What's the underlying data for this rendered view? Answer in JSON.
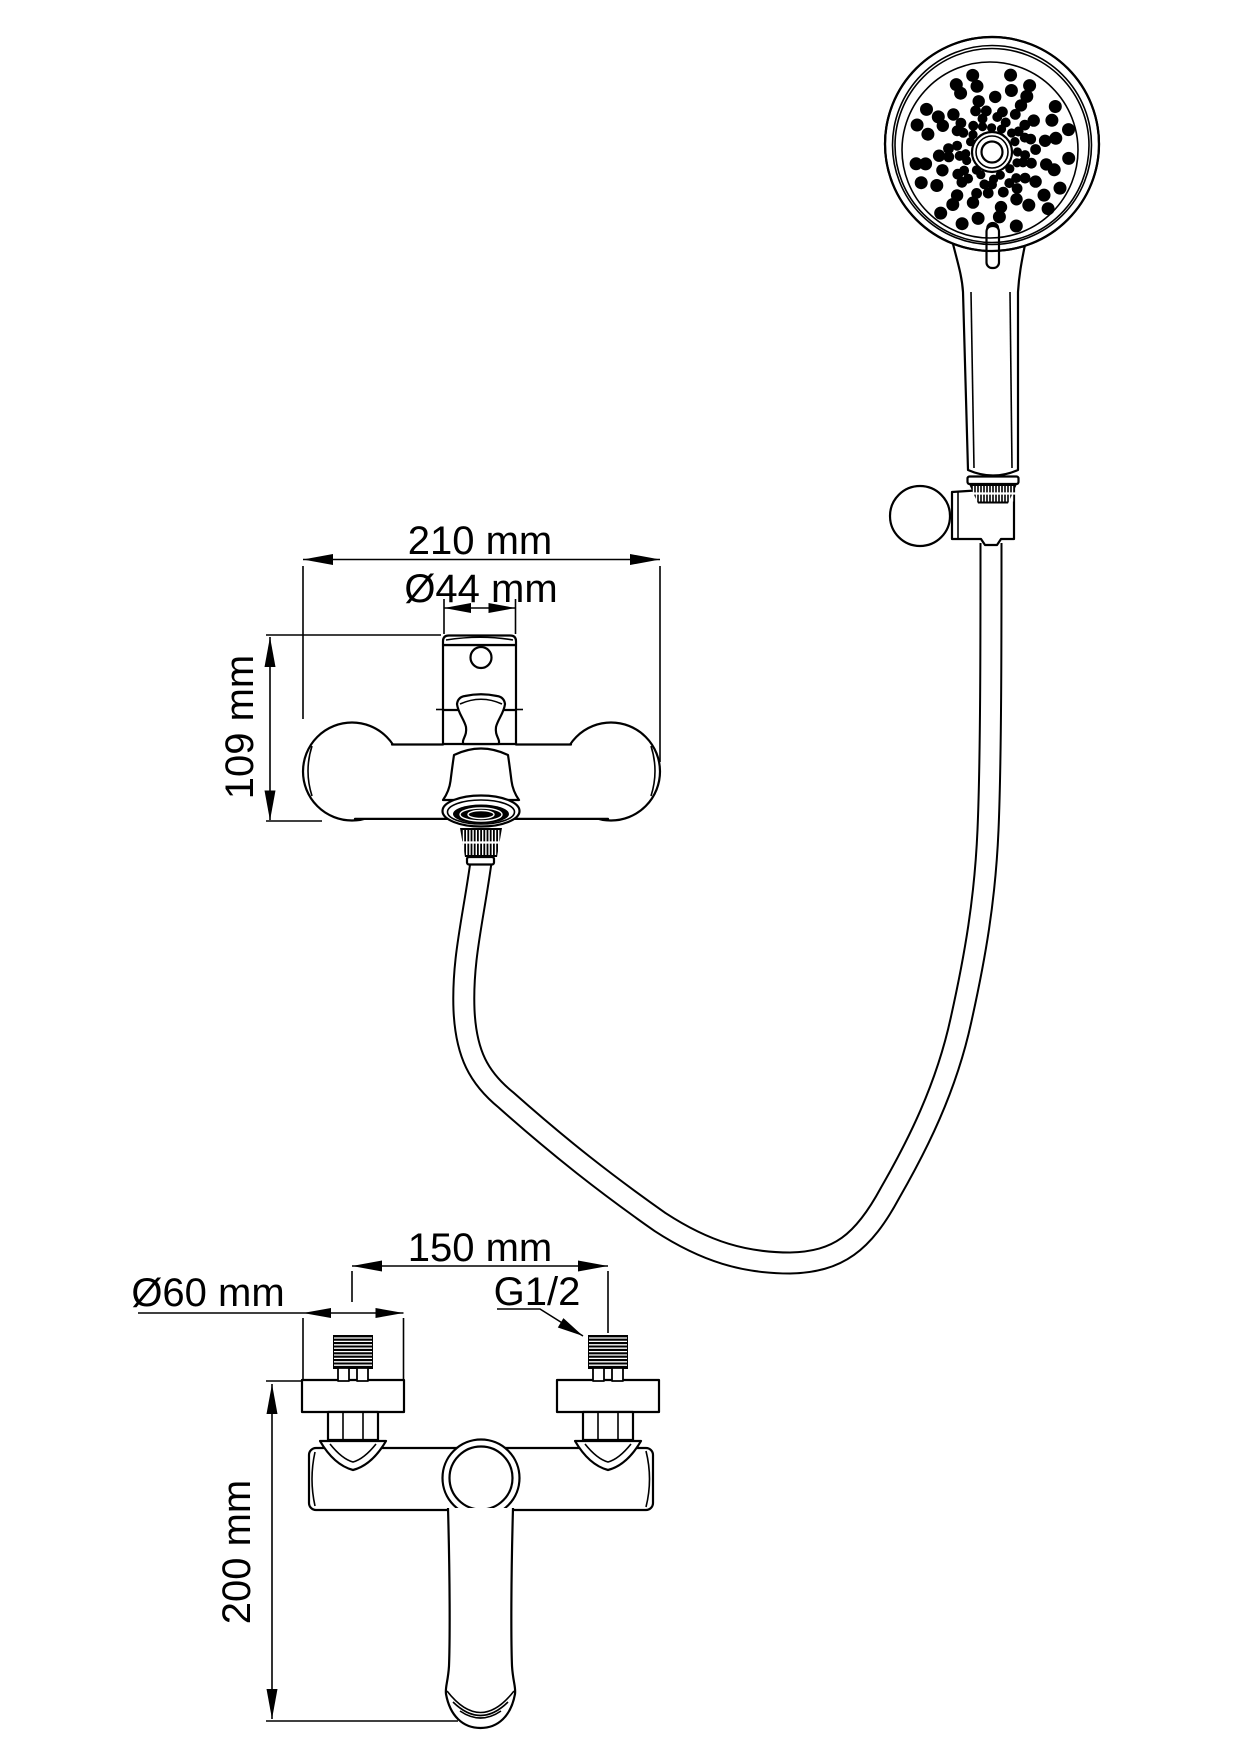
{
  "colors": {
    "line": "#000000",
    "background": "#ffffff"
  },
  "labels": {
    "front_width": "210 mm",
    "cartridge_diameter": "Ø44 mm",
    "front_height": "109 mm",
    "pipe_spacing": "150 mm",
    "escutcheon_diameter": "Ø60 mm",
    "thread_size": "G1/2",
    "side_height": "200 mm"
  },
  "shower_head": {
    "face_center": {
      "x": 990,
      "y": 150
    },
    "face_radius": 84,
    "pattern_center": {
      "x": 992,
      "y": 152
    },
    "dot_rings": [
      {
        "radius": 25.5,
        "count": 16,
        "dot_radius": 4.6,
        "phase": 0.0
      },
      {
        "radius": 34.0,
        "count": 17,
        "dot_radius": 5.0,
        "phase": 0.18
      },
      {
        "radius": 42.5,
        "count": 19,
        "dot_radius": 5.4,
        "phase": 0.05
      },
      {
        "radius": 54.0,
        "count": 15,
        "dot_radius": 6.2,
        "phase": 0.3
      },
      {
        "radius": 66.0,
        "count": 16,
        "dot_radius": 6.5,
        "phase": 0.1
      },
      {
        "radius": 78.0,
        "count": 17,
        "dot_radius": 6.5,
        "phase": 0.25
      }
    ]
  },
  "textures": {
    "thread_hatch": [
      {
        "x": 334,
        "y": 1336,
        "width": 38,
        "height": 32,
        "step": 3.4
      },
      {
        "x": 589,
        "y": 1336,
        "width": 38,
        "height": 32,
        "step": 3.4
      }
    ],
    "knurl_hatch": [
      {
        "x": 462,
        "y": 830,
        "width": 38,
        "height": 25,
        "step": 3.2,
        "gap_y": 842.5
      },
      {
        "x": 972,
        "y": 486,
        "width": 42,
        "height": 15.5,
        "step": 3.0,
        "gap_y": 493.5
      }
    ]
  }
}
